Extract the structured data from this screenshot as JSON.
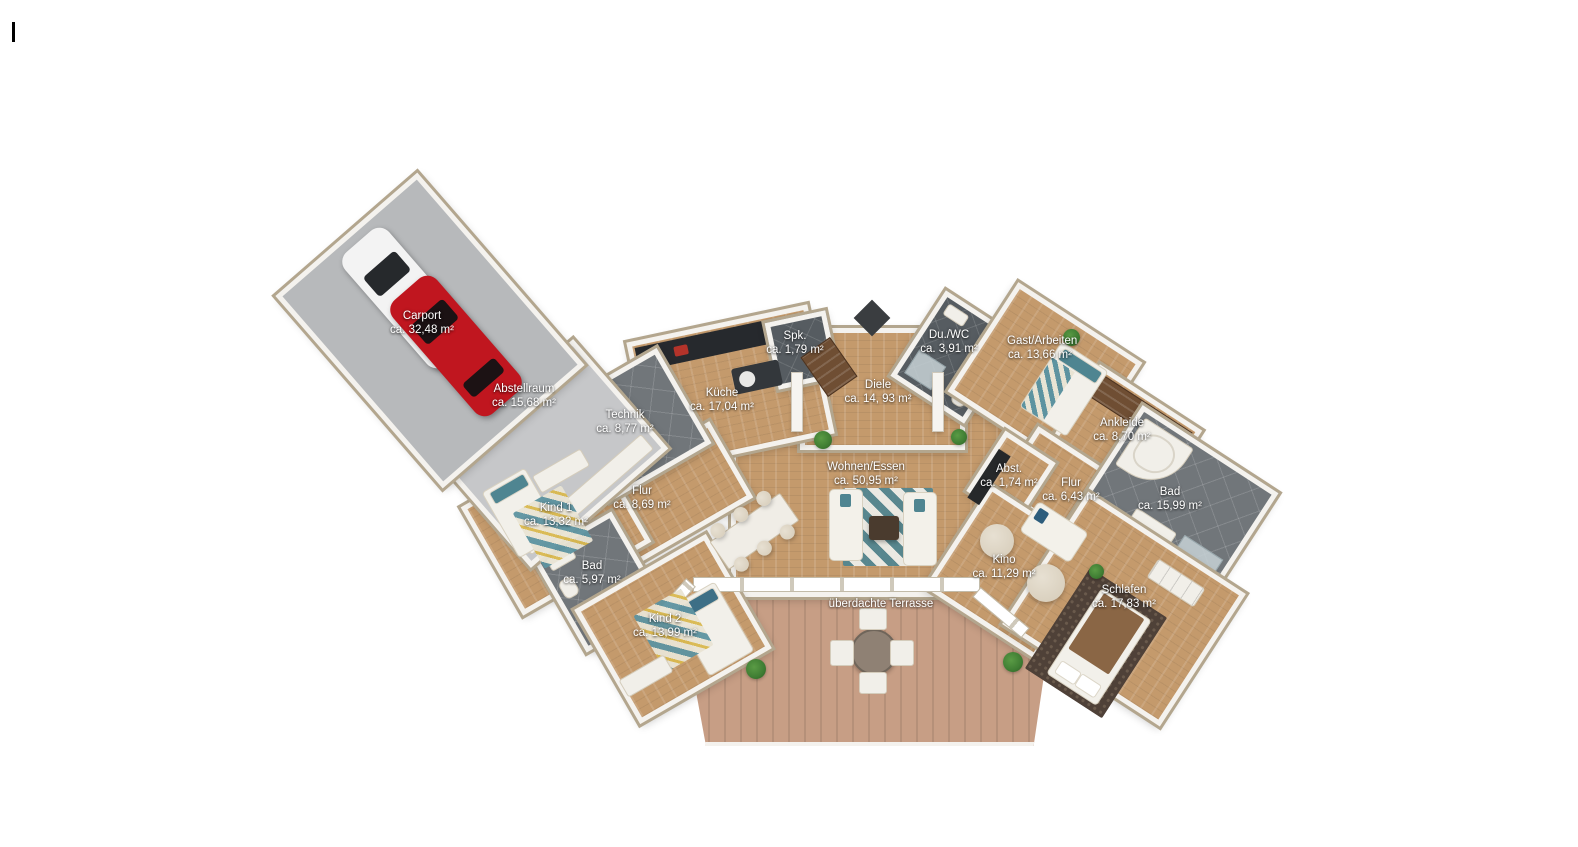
{
  "floorplan": {
    "rooms": [
      {
        "id": "carport",
        "label": "Carport",
        "area": "ca. 32,48 m²"
      },
      {
        "id": "abstellraum",
        "label": "Abstellraum",
        "area": "ca. 15,68 m²"
      },
      {
        "id": "technik",
        "label": "Technik",
        "area": "ca. 8,77 m²"
      },
      {
        "id": "kueche",
        "label": "Küche",
        "area": "ca. 17,04 m²"
      },
      {
        "id": "speisekammer",
        "label": "Spk.",
        "area": "ca. 1,79 m²"
      },
      {
        "id": "diele",
        "label": "Diele",
        "area": "ca. 14, 93 m²"
      },
      {
        "id": "dusche-wc",
        "label": "Du./WC",
        "area": "ca. 3,91 m²"
      },
      {
        "id": "gast-arbeiten",
        "label": "Gast/Arbeiten",
        "area": "ca. 13,66 m²"
      },
      {
        "id": "ankleide",
        "label": "Ankleide",
        "area": "ca. 8,70 m²"
      },
      {
        "id": "bad-gross",
        "label": "Bad",
        "area": "ca. 15,99 m²"
      },
      {
        "id": "flur-rechts",
        "label": "Flur",
        "area": "ca. 6,43 m²"
      },
      {
        "id": "abstellkammer",
        "label": "Abst.",
        "area": "ca. 1,74 m²"
      },
      {
        "id": "wohnen-essen",
        "label": "Wohnen/Essen",
        "area": "ca. 50,95 m²"
      },
      {
        "id": "flur-links",
        "label": "Flur",
        "area": "ca. 8,69 m²"
      },
      {
        "id": "kind1",
        "label": "Kind 1",
        "area": "ca. 13,32 m²"
      },
      {
        "id": "bad-klein",
        "label": "Bad",
        "area": "ca. 5,97 m²"
      },
      {
        "id": "kind2",
        "label": "Kind 2",
        "area": "ca. 13,99 m²"
      },
      {
        "id": "kino",
        "label": "Kino",
        "area": "ca. 11,29 m²"
      },
      {
        "id": "schlafen",
        "label": "Schlafen",
        "area": "ca. 17,83 m²"
      },
      {
        "id": "terrasse",
        "label": "überdachte Terrasse",
        "area": ""
      }
    ],
    "colors": {
      "wood": "#c49a6c",
      "terrace": "#c79e85",
      "concrete": "#b7b9bb",
      "concrete_light": "#c6c7c9",
      "tile": "#71767a",
      "tile_dark": "#565c61",
      "wall": "#f4f2ee",
      "wall_cap": "#b3a68e",
      "accent_teal": "#4f8591",
      "car_red": "#c0161f",
      "car_white": "#f3f3f3",
      "plant": "#3f7d33",
      "bed_brown": "#8a6645"
    }
  }
}
